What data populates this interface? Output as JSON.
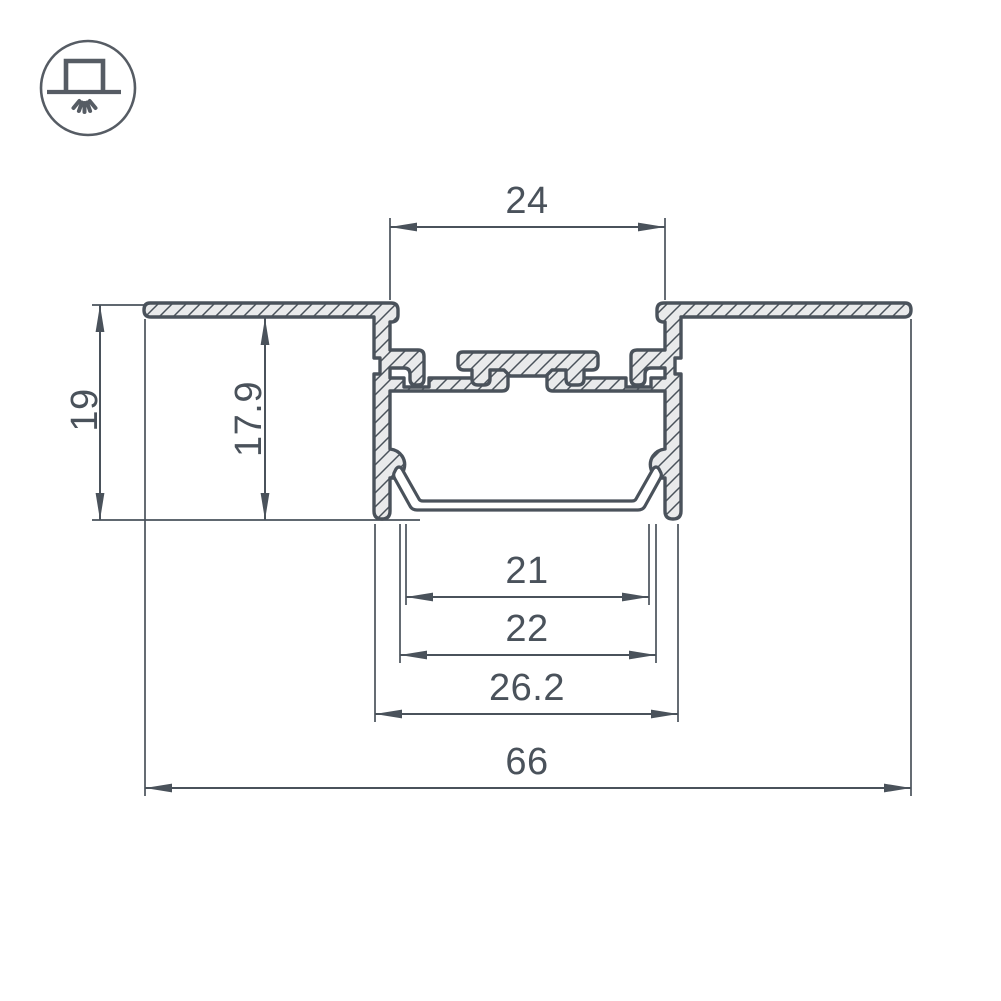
{
  "window": {
    "background": "#ffffff"
  },
  "corner_icon": {
    "name": "recessed-luminaire-icon",
    "description": "circle outline containing a recessed box on a ceiling line with light rays shining downward"
  },
  "drawing": {
    "type": "profile-cross-section",
    "colors": {
      "line": "#4a525b",
      "profile_fill": "#e9eaeb",
      "diffuser_fill": "#ffffff",
      "background": "#ffffff"
    },
    "dimensions": {
      "top_opening_width": {
        "value": "24",
        "orientation": "horizontal"
      },
      "overall_height": {
        "value": "19",
        "orientation": "vertical"
      },
      "inner_depth": {
        "value": "17.9",
        "orientation": "vertical"
      },
      "diffuser_inner_width": {
        "value": "21",
        "orientation": "horizontal"
      },
      "diffuser_outer_width": {
        "value": "22",
        "orientation": "horizontal"
      },
      "body_width": {
        "value": "26.2",
        "orientation": "horizontal"
      },
      "overall_flange_width": {
        "value": "66",
        "orientation": "horizontal"
      }
    }
  }
}
